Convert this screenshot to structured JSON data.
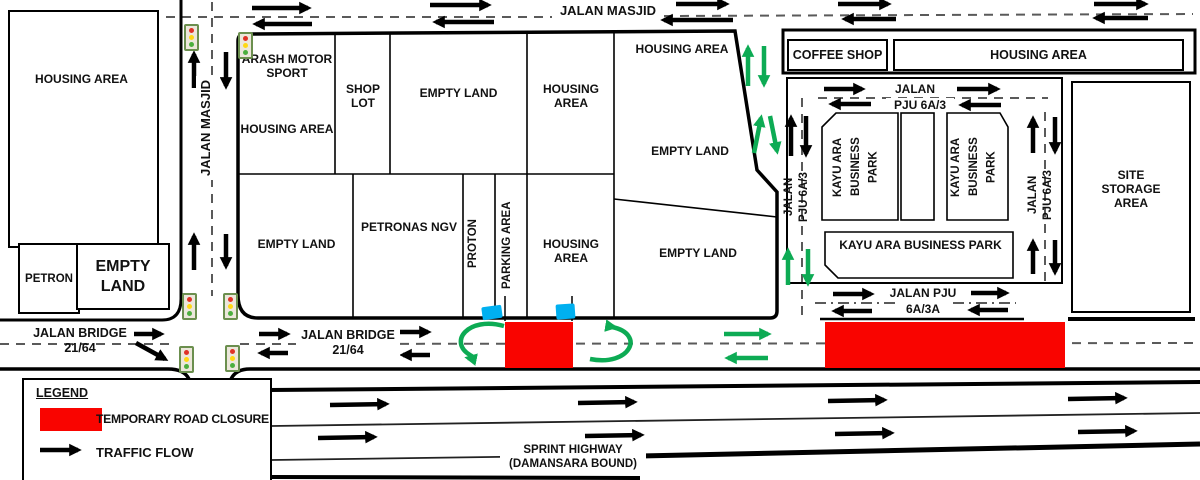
{
  "legend": {
    "title": "LEGEND",
    "items": [
      {
        "label": "TEMPORARY ROAD CLOSURE"
      },
      {
        "label": "TRAFFIC FLOW"
      }
    ]
  },
  "roads": {
    "jalan_masjid_top": "JALAN MASJID",
    "jalan_masjid_west": "JALAN MASJID",
    "jalan_pju_6a3_top_line1": "JALAN",
    "jalan_pju_6a3_top_line2": "PJU 6A/3",
    "jalan_pju_6a3_west": "JALAN\nPJU 6A/3",
    "jalan_pju_6a3_east": "JALAN\nPJU 6A/3",
    "jalan_pju_6a3a_line1": "JALAN PJU",
    "jalan_pju_6a3a_line2": "6A/3A",
    "jalan_bridge_west": "JALAN BRIDGE\n21/64",
    "jalan_bridge_mid": "JALAN BRIDGE\n21/64",
    "sprint_highway": "SPRINT HIGHWAY\n(DAMANSARA BOUND)"
  },
  "areas": {
    "housing_west": "HOUSING AREA",
    "petron": "PETRON",
    "empty_land_sw": "EMPTY LAND",
    "arash_motor_sport": "ARASH MOTOR SPORT",
    "housing_arash": "HOUSING AREA",
    "shop_lot": "SHOP LOT",
    "empty_land_top": "EMPTY LAND",
    "housing_top_mid": "HOUSING AREA",
    "housing_north_inner": "HOUSING AREA",
    "empty_land_east_upper": "EMPTY LAND",
    "empty_land_east_lower": "EMPTY LAND",
    "empty_land_row2": "EMPTY LAND",
    "petronas_ngv": "PETRONAS NGV",
    "proton": "PROTON",
    "parking_area": "PARKING AREA",
    "housing_row2": "HOUSING AREA",
    "coffee_shop": "COFFEE SHOP",
    "housing_ne": "HOUSING AREA",
    "kayu_ara_v1": "KAYU ARA\nBUSINESS\nPARK",
    "kayu_ara_v2": "KAYU ARA\nBUSINESS\nPARK",
    "kayu_ara_main": "KAYU ARA BUSINESS PARK",
    "site_storage": "SITE STORAGE AREA"
  },
  "colors": {
    "closure_red": "#F90400",
    "flow_green": "#0DAB54",
    "barrier_blue": "#00B0F0",
    "road_black": "#000000"
  }
}
